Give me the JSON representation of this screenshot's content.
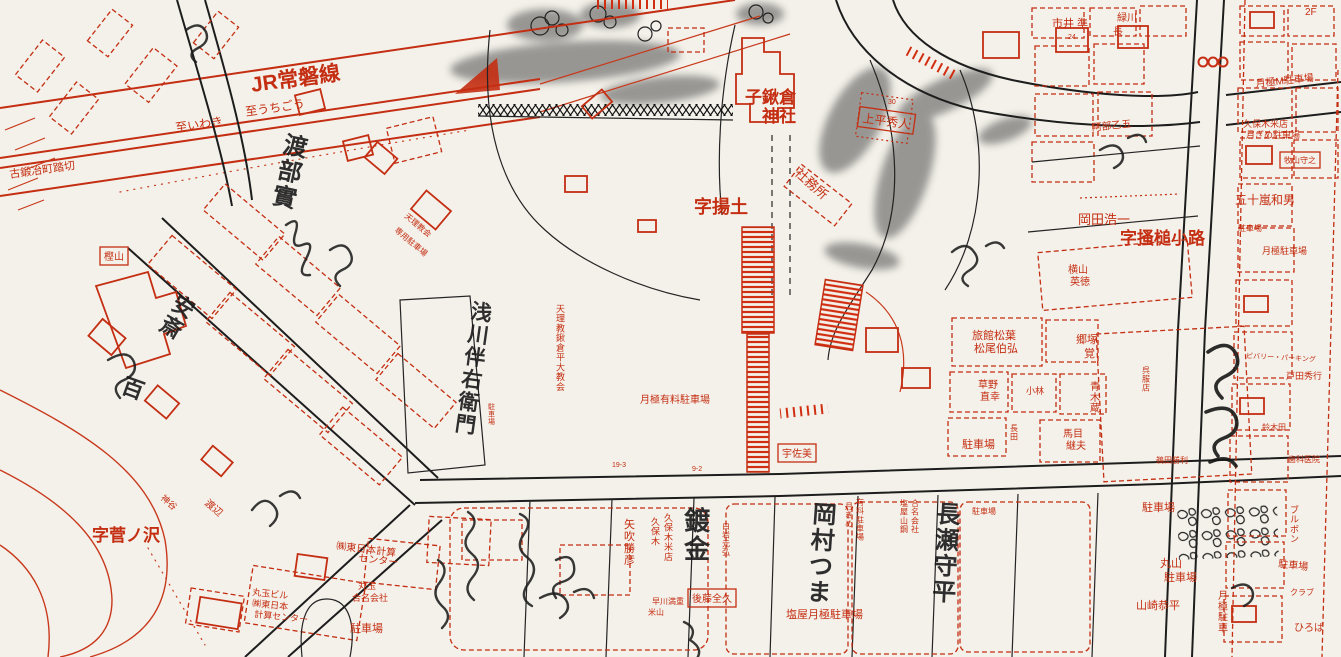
{
  "map": {
    "background_color": "#f4f1ea",
    "ink_red": "#c42e12",
    "ink_black": "#1a1a1a",
    "labels": [
      {
        "id": "jr-joban-line",
        "text": "JR常磐線",
        "x": 252,
        "y": 92,
        "size": 21,
        "bold": true,
        "rot": -8
      },
      {
        "id": "to-uchigo",
        "text": "至うちごう",
        "x": 246,
        "y": 116,
        "size": 12,
        "rot": -8
      },
      {
        "id": "to-iwaki",
        "text": "至いわき",
        "x": 176,
        "y": 132,
        "size": 12,
        "rot": -8
      },
      {
        "id": "kokajimachi-crossing",
        "text": "古鍛冶町踏切",
        "x": 10,
        "y": 178,
        "size": 11,
        "rot": -8
      },
      {
        "id": "kokuwagura-shrine-line1",
        "text": "子鍬倉",
        "x": 745,
        "y": 103,
        "size": 17,
        "bold": true
      },
      {
        "id": "kokuwagura-shrine-line2",
        "text": "神社",
        "x": 762,
        "y": 122,
        "size": 17,
        "bold": true
      },
      {
        "id": "shamusho",
        "text": "社務所",
        "x": 794,
        "y": 174,
        "size": 13,
        "rot": 42
      },
      {
        "id": "aza-agetsuchi",
        "text": "字揚土",
        "x": 694,
        "y": 213,
        "size": 18,
        "bold": true
      },
      {
        "id": "uedaira-hideto",
        "text": "上平秀人",
        "x": 862,
        "y": 122,
        "size": 12,
        "rot": 8,
        "box": true
      },
      {
        "id": "okada-koichi",
        "text": "岡田浩一",
        "x": 1078,
        "y": 224,
        "size": 13
      },
      {
        "id": "aza-kakitsuchi-koji",
        "text": "字搔槌小路",
        "x": 1120,
        "y": 244,
        "size": 17,
        "bold": true
      },
      {
        "id": "yokoyama-hidenori-1",
        "text": "横山",
        "x": 1068,
        "y": 273,
        "size": 10
      },
      {
        "id": "yokoyama-hidenori-2",
        "text": "英徳",
        "x": 1070,
        "y": 285,
        "size": 10
      },
      {
        "id": "igarashi-kazuo",
        "text": "五十嵐和男",
        "x": 1235,
        "y": 204,
        "size": 12
      },
      {
        "id": "kuboki-rice-parking-1",
        "text": "久保木米店",
        "x": 1243,
        "y": 127,
        "size": 9
      },
      {
        "id": "kuboki-rice-parking-2",
        "text": "月ぎめ駐車場",
        "x": 1246,
        "y": 138,
        "size": 9
      },
      {
        "id": "abe-otogo",
        "text": "阿部乙五",
        "x": 1092,
        "y": 131,
        "size": 10,
        "rot": -6
      },
      {
        "id": "makiyama-moriyuki",
        "text": "牧山守之",
        "x": 1284,
        "y": 163,
        "size": 8,
        "box": true
      },
      {
        "id": "tsukigime-m-parking",
        "text": "月極M駐車場",
        "x": 1256,
        "y": 87,
        "size": 10,
        "rot": -6
      },
      {
        "id": "tsukigime-parking-r",
        "text": "月極駐車場",
        "x": 1262,
        "y": 254,
        "size": 9
      },
      {
        "id": "parking-ne",
        "text": "駐車場",
        "x": 1238,
        "y": 231,
        "size": 8
      },
      {
        "id": "ichii",
        "text": "市井 準",
        "x": 1052,
        "y": 27,
        "size": 11
      },
      {
        "id": "midorikawa-1",
        "text": "緑川",
        "x": 1117,
        "y": 21,
        "size": 10
      },
      {
        "id": "midorikawa-2",
        "text": "長",
        "x": 1113,
        "y": 35,
        "size": 10
      },
      {
        "id": "floor-2f",
        "text": "2F",
        "x": 1305,
        "y": 15,
        "size": 10
      },
      {
        "id": "ryokan-matsuba-1",
        "text": "旅館松葉",
        "x": 972,
        "y": 339,
        "size": 11
      },
      {
        "id": "ryokan-matsuba-2",
        "text": "松尾伯弘",
        "x": 974,
        "y": 352,
        "size": 11
      },
      {
        "id": "gotsuka-1",
        "text": "郷塚",
        "x": 1076,
        "y": 343,
        "size": 11
      },
      {
        "id": "gotsuka-2",
        "text": "覚",
        "x": 1084,
        "y": 357,
        "size": 11
      },
      {
        "id": "kusano-1",
        "text": "草野",
        "x": 978,
        "y": 388,
        "size": 10
      },
      {
        "id": "kusano-2",
        "text": "直幸",
        "x": 980,
        "y": 400,
        "size": 10
      },
      {
        "id": "kobayashi",
        "text": "小林",
        "x": 1026,
        "y": 394,
        "size": 9
      },
      {
        "id": "aoki-kura",
        "text": "青木蔵",
        "x": 1090,
        "y": 390,
        "size": 10,
        "vertical": true
      },
      {
        "id": "manome-1",
        "text": "馬目",
        "x": 1063,
        "y": 437,
        "size": 10
      },
      {
        "id": "manome-2",
        "text": "継夫",
        "x": 1066,
        "y": 449,
        "size": 10
      },
      {
        "id": "gofuku-store",
        "text": "呉服店",
        "x": 1142,
        "y": 373,
        "size": 8,
        "vertical": true
      },
      {
        "id": "parking-center",
        "text": "駐車場",
        "x": 962,
        "y": 448,
        "size": 11
      },
      {
        "id": "nagata",
        "text": "長田",
        "x": 1010,
        "y": 431,
        "size": 8,
        "vertical": true
      },
      {
        "id": "usami",
        "text": "宇佐美",
        "x": 782,
        "y": 457,
        "size": 10,
        "box": true
      },
      {
        "id": "tsukigime-paid-parking",
        "text": "月極有料駐車場",
        "x": 640,
        "y": 403,
        "size": 10
      },
      {
        "id": "tenrikyo-church-1",
        "text": "天理教会",
        "x": 404,
        "y": 217,
        "size": 8,
        "rot": 40
      },
      {
        "id": "tenrikyo-church-2",
        "text": "専用駐車場",
        "x": 394,
        "y": 231,
        "size": 8,
        "rot": 40
      },
      {
        "id": "tenrikyo-taira-church",
        "text": "天理教鍬倉平大教会",
        "x": 556,
        "y": 312,
        "size": 9,
        "vertical": true
      },
      {
        "id": "parking-v",
        "text": "駐車場",
        "x": 488,
        "y": 409,
        "size": 7,
        "vertical": true
      },
      {
        "id": "yabuki-katsuhiko",
        "text": "矢吹勝彦",
        "x": 624,
        "y": 528,
        "size": 11,
        "vertical": true
      },
      {
        "id": "kuboki-rice-v",
        "text": "久保木米店",
        "x": 664,
        "y": 521,
        "size": 9,
        "vertical": true
      },
      {
        "id": "kuboki-v",
        "text": "久保木",
        "x": 651,
        "y": 525,
        "size": 9,
        "vertical": true
      },
      {
        "id": "goto-zenkyu",
        "text": "後藤全久",
        "x": 692,
        "y": 602,
        "size": 10,
        "box": true
      },
      {
        "id": "hayakawa",
        "text": "早川満重",
        "x": 652,
        "y": 604,
        "size": 8
      },
      {
        "id": "yoneyama",
        "text": "米山",
        "x": 648,
        "y": 615,
        "size": 8
      },
      {
        "id": "shiraiwa-motohiro",
        "text": "白岩元弘",
        "x": 722,
        "y": 529,
        "size": 8,
        "vertical": true
      },
      {
        "id": "shioya-tsukigime-parking",
        "text": "塩屋月極駐車場",
        "x": 786,
        "y": 618,
        "size": 11
      },
      {
        "id": "tsukigime-col-1",
        "text": "月ぎめ",
        "x": 845,
        "y": 509,
        "size": 8,
        "vertical": true
      },
      {
        "id": "tsukigime-col-2",
        "text": "有料駐車場",
        "x": 856,
        "y": 505,
        "size": 8,
        "vertical": true
      },
      {
        "id": "shioya-yamako-1",
        "text": "塩屋山鋼",
        "x": 900,
        "y": 506,
        "size": 8,
        "vertical": true
      },
      {
        "id": "shioya-yamako-2",
        "text": "合名会社",
        "x": 911,
        "y": 506,
        "size": 8,
        "vertical": true
      },
      {
        "id": "parking-mid",
        "text": "駐車場",
        "x": 972,
        "y": 514,
        "size": 8
      },
      {
        "id": "maruyama-parking-1",
        "text": "丸山",
        "x": 1160,
        "y": 567,
        "size": 11
      },
      {
        "id": "maruyama-parking-2",
        "text": "駐車場",
        "x": 1164,
        "y": 581,
        "size": 11
      },
      {
        "id": "yamazaki-kyohei",
        "text": "山崎恭平",
        "x": 1136,
        "y": 609,
        "size": 11
      },
      {
        "id": "parking-se",
        "text": "駐車場",
        "x": 1142,
        "y": 511,
        "size": 11
      },
      {
        "id": "tsukigime-col-3",
        "text": "月極駐車",
        "x": 1218,
        "y": 599,
        "size": 10,
        "vertical": true
      },
      {
        "id": "bourbon",
        "text": "ブルボン",
        "x": 1290,
        "y": 513,
        "size": 9,
        "vertical": true
      },
      {
        "id": "parking-fr",
        "text": "駐車場",
        "x": 1278,
        "y": 567,
        "size": 10,
        "rot": 6
      },
      {
        "id": "club",
        "text": "クラブ",
        "x": 1290,
        "y": 595,
        "size": 8
      },
      {
        "id": "hiroba",
        "text": "ひろば",
        "x": 1294,
        "y": 631,
        "size": 10
      },
      {
        "id": "higashinihon-keisan-1",
        "text": "㈱東日本計算",
        "x": 336,
        "y": 549,
        "size": 10,
        "rot": 7
      },
      {
        "id": "higashinihon-keisan-2",
        "text": "センター",
        "x": 358,
        "y": 561,
        "size": 10,
        "rot": 7
      },
      {
        "id": "marutama-bldg-1",
        "text": "丸玉ビル",
        "x": 252,
        "y": 595,
        "size": 9,
        "rot": 6
      },
      {
        "id": "marutama-bldg-2",
        "text": "㈱東日本",
        "x": 252,
        "y": 606,
        "size": 9,
        "rot": 6
      },
      {
        "id": "marutama-bldg-3",
        "text": "計算センター",
        "x": 254,
        "y": 617,
        "size": 9,
        "rot": 6
      },
      {
        "id": "marutama-gomei-1",
        "text": "丸玉",
        "x": 358,
        "y": 589,
        "size": 9
      },
      {
        "id": "marutama-gomei-2",
        "text": "合名会社",
        "x": 352,
        "y": 601,
        "size": 9
      },
      {
        "id": "parking-sw",
        "text": "駐車場",
        "x": 350,
        "y": 632,
        "size": 11
      },
      {
        "id": "watanabe",
        "text": "渡辺",
        "x": 204,
        "y": 504,
        "size": 10,
        "rot": 40
      },
      {
        "id": "kamiya",
        "text": "神谷",
        "x": 160,
        "y": 499,
        "size": 9,
        "rot": 40
      },
      {
        "id": "aza-suganosawa",
        "text": "字菅ノ沢",
        "x": 92,
        "y": 541,
        "size": 17,
        "bold": true,
        "color": "black"
      },
      {
        "id": "kashiyama",
        "text": "樫山",
        "x": 104,
        "y": 260,
        "size": 10,
        "box": true
      },
      {
        "id": "beverly-parking",
        "text": "ビバリー・パーキング",
        "x": 1246,
        "y": 358,
        "size": 7,
        "rot": 3
      },
      {
        "id": "toda-hideyuki",
        "text": "戸田秀行",
        "x": 1286,
        "y": 379,
        "size": 9
      },
      {
        "id": "dental-clinic",
        "text": "歯科医院",
        "x": 1288,
        "y": 462,
        "size": 8
      },
      {
        "id": "suzukita",
        "text": "鈴木田",
        "x": 1262,
        "y": 430,
        "size": 8
      },
      {
        "id": "uda-katsutoshi",
        "text": "鵜田勝利",
        "x": 1156,
        "y": 463,
        "size": 8
      },
      {
        "id": "parcel-no-24",
        "text": "24",
        "x": 1068,
        "y": 39,
        "size": 7
      },
      {
        "id": "parcel-no-30",
        "text": "30",
        "x": 888,
        "y": 104,
        "size": 7
      },
      {
        "id": "parcel-no-19-3",
        "text": "19-3",
        "x": 612,
        "y": 467,
        "size": 7
      },
      {
        "id": "parcel-no-9-2",
        "text": "9-2",
        "x": 692,
        "y": 471,
        "size": 7
      }
    ],
    "handwriting": [
      {
        "id": "hw-watanabe",
        "text": "渡部實",
        "x": 282,
        "y": 152,
        "size": 24,
        "vertical": true,
        "rot": 12
      },
      {
        "id": "hw-asakawa",
        "text": "浅川伴右衛門",
        "x": 470,
        "y": 318,
        "size": 21,
        "vertical": true,
        "rot": 8
      },
      {
        "id": "hw-okamura",
        "text": "岡村つま",
        "x": 812,
        "y": 522,
        "size": 24,
        "vertical": true,
        "rot": 4
      },
      {
        "id": "hw-nagase",
        "text": "長瀬守平",
        "x": 936,
        "y": 522,
        "size": 24,
        "vertical": true,
        "rot": 3
      },
      {
        "id": "hw-mekki",
        "text": "鍍金",
        "x": 684,
        "y": 530,
        "size": 26,
        "vertical": true,
        "rot": 0
      },
      {
        "id": "hw-anzai",
        "text": "安斎",
        "x": 170,
        "y": 308,
        "size": 22,
        "vertical": true,
        "rot": 30
      },
      {
        "id": "hw-momo",
        "text": "百",
        "x": 120,
        "y": 392,
        "size": 22,
        "rot": 20
      }
    ]
  }
}
